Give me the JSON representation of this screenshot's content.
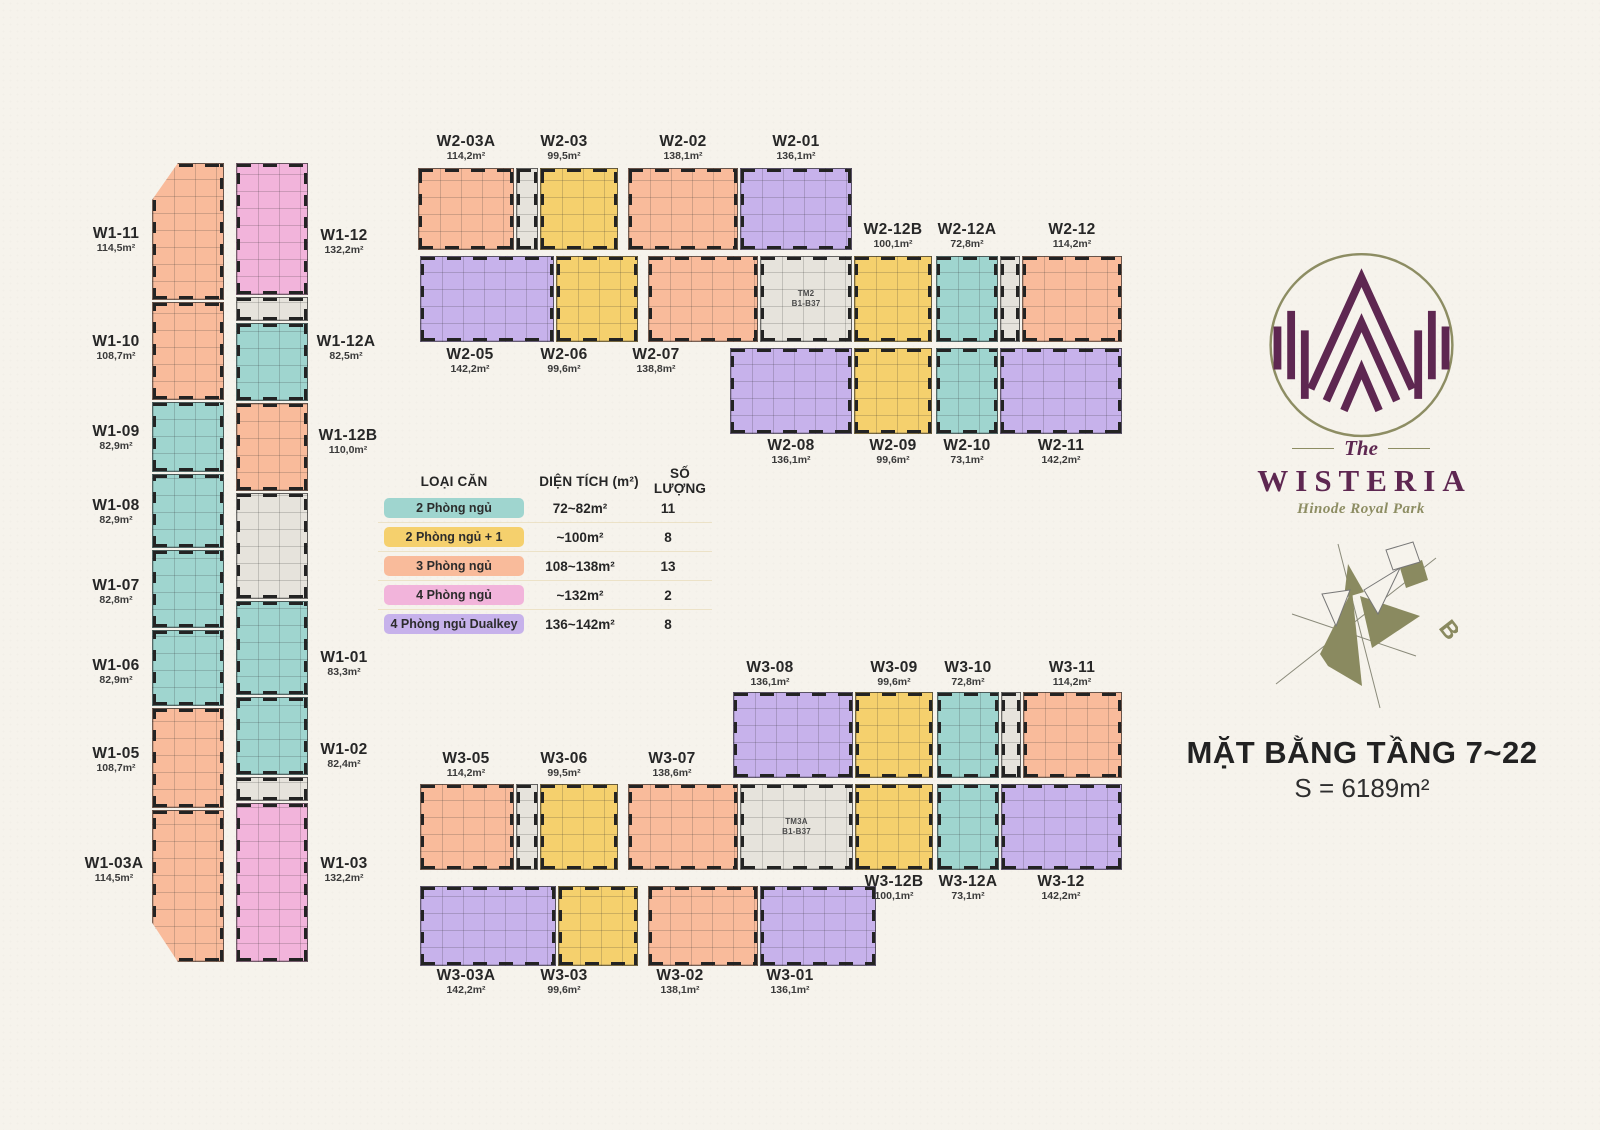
{
  "page": {
    "background": "#f6f3ec",
    "ink": "#2b2b2b"
  },
  "title": {
    "main": "MẶT BẰNG TẦNG 7~22",
    "area": "S = 6189m²"
  },
  "logo": {
    "the": "The",
    "name": "WISTERIA",
    "tagline": "Hinode Royal Park",
    "mark_color": "#5e2751",
    "ring_color": "#8d8d63"
  },
  "compass": {
    "label": "B",
    "color": "#8a8a60"
  },
  "legend": {
    "headers": [
      "LOẠI CĂN",
      "DIỆN TÍCH (m²)",
      "SỐ LƯỢNG"
    ],
    "rows": [
      {
        "label": "2 Phòng ngủ",
        "type": "2br",
        "color": "#9fd5cf",
        "area": "72~82m²",
        "count": "11"
      },
      {
        "label": "2 Phòng ngủ + 1",
        "type": "2br1",
        "color": "#f5d06d",
        "area": "~100m²",
        "count": "8"
      },
      {
        "label": "3 Phòng ngủ",
        "type": "3br",
        "color": "#f9bb9b",
        "area": "108~138m²",
        "count": "13"
      },
      {
        "label": "4 Phòng ngủ",
        "type": "4br",
        "color": "#f2b4db",
        "area": "~132m²",
        "count": "2"
      },
      {
        "label": "4 Phòng ngủ Dualkey",
        "type": "dual",
        "color": "#c7b2eb",
        "area": "136~142m²",
        "count": "8"
      }
    ]
  },
  "floorplan": {
    "colors": {
      "2br": "#9fd5cf",
      "2br1": "#f5d06d",
      "3br": "#f9bb9b",
      "4br": "#f2b4db",
      "dual": "#c7b2eb",
      "core": "#e6e3dc"
    },
    "units": [
      {
        "n": "W1-11",
        "t": "3br",
        "x": 152,
        "y": 163,
        "w": 72,
        "h": 137,
        "c": "tl"
      },
      {
        "n": "W1-10",
        "t": "3br",
        "x": 152,
        "y": 302,
        "w": 72,
        "h": 98
      },
      {
        "n": "W1-09",
        "t": "2br",
        "x": 152,
        "y": 402,
        "w": 72,
        "h": 70
      },
      {
        "n": "W1-08",
        "t": "2br",
        "x": 152,
        "y": 474,
        "w": 72,
        "h": 74
      },
      {
        "n": "W1-07",
        "t": "2br",
        "x": 152,
        "y": 550,
        "w": 72,
        "h": 78
      },
      {
        "n": "W1-06",
        "t": "2br",
        "x": 152,
        "y": 630,
        "w": 72,
        "h": 76
      },
      {
        "n": "W1-05",
        "t": "3br",
        "x": 152,
        "y": 708,
        "w": 72,
        "h": 100
      },
      {
        "n": "W1-03A",
        "t": "3br",
        "x": 152,
        "y": 810,
        "w": 72,
        "h": 152,
        "c": "bl"
      },
      {
        "n": "W1-12",
        "t": "4br",
        "x": 236,
        "y": 163,
        "w": 72,
        "h": 132
      },
      {
        "t": "core",
        "x": 236,
        "y": 297,
        "w": 72,
        "h": 24
      },
      {
        "n": "W1-12A",
        "t": "2br",
        "x": 236,
        "y": 323,
        "w": 72,
        "h": 78
      },
      {
        "n": "W1-12B",
        "t": "3br",
        "x": 236,
        "y": 403,
        "w": 72,
        "h": 88
      },
      {
        "t": "core",
        "x": 236,
        "y": 493,
        "w": 72,
        "h": 106
      },
      {
        "n": "W1-01",
        "t": "2br",
        "x": 236,
        "y": 601,
        "w": 72,
        "h": 94
      },
      {
        "n": "W1-02",
        "t": "2br",
        "x": 236,
        "y": 697,
        "w": 72,
        "h": 78
      },
      {
        "t": "core",
        "x": 236,
        "y": 777,
        "w": 72,
        "h": 24
      },
      {
        "n": "W1-03",
        "t": "4br",
        "x": 236,
        "y": 803,
        "w": 72,
        "h": 159
      },
      {
        "n": "W2-03A",
        "t": "3br",
        "x": 418,
        "y": 168,
        "w": 96,
        "h": 82
      },
      {
        "t": "core",
        "x": 516,
        "y": 168,
        "w": 22,
        "h": 82
      },
      {
        "n": "W2-03",
        "t": "2br1",
        "x": 540,
        "y": 168,
        "w": 78,
        "h": 82
      },
      {
        "n": "W2-02",
        "t": "3br",
        "x": 628,
        "y": 168,
        "w": 110,
        "h": 82
      },
      {
        "n": "W2-01",
        "t": "dual",
        "x": 740,
        "y": 168,
        "w": 112,
        "h": 82
      },
      {
        "n": "W2-05",
        "t": "dual",
        "x": 420,
        "y": 256,
        "w": 134,
        "h": 86
      },
      {
        "n": "W2-06",
        "t": "2br1",
        "x": 556,
        "y": 256,
        "w": 82,
        "h": 86
      },
      {
        "n": "W2-07",
        "t": "3br",
        "x": 648,
        "y": 256,
        "w": 110,
        "h": 86
      },
      {
        "t": "core",
        "x": 760,
        "y": 256,
        "w": 92,
        "h": 86,
        "lbl": "TM2\nB1-B37"
      },
      {
        "n": "W2-12B",
        "t": "2br1",
        "x": 854,
        "y": 256,
        "w": 78,
        "h": 86
      },
      {
        "n": "W2-12A",
        "t": "2br",
        "x": 936,
        "y": 256,
        "w": 62,
        "h": 86
      },
      {
        "t": "core",
        "x": 1000,
        "y": 256,
        "w": 20,
        "h": 86
      },
      {
        "n": "W2-12",
        "t": "3br",
        "x": 1022,
        "y": 256,
        "w": 100,
        "h": 86
      },
      {
        "n": "W2-08",
        "t": "dual",
        "x": 730,
        "y": 348,
        "w": 122,
        "h": 86
      },
      {
        "n": "W2-09",
        "t": "2br1",
        "x": 854,
        "y": 348,
        "w": 78,
        "h": 86
      },
      {
        "n": "W2-10",
        "t": "2br",
        "x": 936,
        "y": 348,
        "w": 62,
        "h": 86
      },
      {
        "n": "W2-11",
        "t": "dual",
        "x": 1000,
        "y": 348,
        "w": 122,
        "h": 86
      },
      {
        "n": "W3-08",
        "t": "dual",
        "x": 733,
        "y": 692,
        "w": 120,
        "h": 86
      },
      {
        "n": "W3-09",
        "t": "2br1",
        "x": 855,
        "y": 692,
        "w": 78,
        "h": 86
      },
      {
        "n": "W3-10",
        "t": "2br",
        "x": 937,
        "y": 692,
        "w": 62,
        "h": 86
      },
      {
        "t": "core",
        "x": 1001,
        "y": 692,
        "w": 20,
        "h": 86
      },
      {
        "n": "W3-11",
        "t": "3br",
        "x": 1023,
        "y": 692,
        "w": 99,
        "h": 86
      },
      {
        "n": "W3-05",
        "t": "3br",
        "x": 420,
        "y": 784,
        "w": 94,
        "h": 86
      },
      {
        "t": "core",
        "x": 516,
        "y": 784,
        "w": 22,
        "h": 86
      },
      {
        "n": "W3-06",
        "t": "2br1",
        "x": 540,
        "y": 784,
        "w": 78,
        "h": 86
      },
      {
        "n": "W3-07",
        "t": "3br",
        "x": 628,
        "y": 784,
        "w": 110,
        "h": 86
      },
      {
        "t": "core",
        "x": 740,
        "y": 784,
        "w": 113,
        "h": 86,
        "lbl": "TM3A\nB1-B37"
      },
      {
        "n": "W3-12B",
        "t": "2br1",
        "x": 855,
        "y": 784,
        "w": 78,
        "h": 86
      },
      {
        "n": "W3-12A",
        "t": "2br",
        "x": 937,
        "y": 784,
        "w": 62,
        "h": 86
      },
      {
        "n": "W3-12",
        "t": "dual",
        "x": 1001,
        "y": 784,
        "w": 121,
        "h": 86
      },
      {
        "n": "W3-03A",
        "t": "dual",
        "x": 420,
        "y": 886,
        "w": 136,
        "h": 80
      },
      {
        "n": "W3-03",
        "t": "2br1",
        "x": 558,
        "y": 886,
        "w": 80,
        "h": 80
      },
      {
        "n": "W3-02",
        "t": "3br",
        "x": 648,
        "y": 886,
        "w": 110,
        "h": 80
      },
      {
        "n": "W3-01",
        "t": "dual",
        "x": 760,
        "y": 886,
        "w": 116,
        "h": 80
      }
    ],
    "labels": [
      {
        "n": "W1-11",
        "a": "114,5m²",
        "x": 116,
        "y": 226
      },
      {
        "n": "W1-10",
        "a": "108,7m²",
        "x": 116,
        "y": 334
      },
      {
        "n": "W1-09",
        "a": "82,9m²",
        "x": 116,
        "y": 424
      },
      {
        "n": "W1-08",
        "a": "82,9m²",
        "x": 116,
        "y": 498
      },
      {
        "n": "W1-07",
        "a": "82,8m²",
        "x": 116,
        "y": 578
      },
      {
        "n": "W1-06",
        "a": "82,9m²",
        "x": 116,
        "y": 658
      },
      {
        "n": "W1-05",
        "a": "108,7m²",
        "x": 116,
        "y": 746
      },
      {
        "n": "W1-03A",
        "a": "114,5m²",
        "x": 114,
        "y": 856
      },
      {
        "n": "W1-12",
        "a": "132,2m²",
        "x": 344,
        "y": 228
      },
      {
        "n": "W1-12A",
        "a": "82,5m²",
        "x": 346,
        "y": 334
      },
      {
        "n": "W1-12B",
        "a": "110,0m²",
        "x": 348,
        "y": 428
      },
      {
        "n": "W1-01",
        "a": "83,3m²",
        "x": 344,
        "y": 650
      },
      {
        "n": "W1-02",
        "a": "82,4m²",
        "x": 344,
        "y": 742
      },
      {
        "n": "W1-03",
        "a": "132,2m²",
        "x": 344,
        "y": 856
      },
      {
        "n": "W2-03A",
        "a": "114,2m²",
        "x": 466,
        "y": 134
      },
      {
        "n": "W2-03",
        "a": "99,5m²",
        "x": 564,
        "y": 134
      },
      {
        "n": "W2-02",
        "a": "138,1m²",
        "x": 683,
        "y": 134
      },
      {
        "n": "W2-01",
        "a": "136,1m²",
        "x": 796,
        "y": 134
      },
      {
        "n": "W2-12B",
        "a": "100,1m²",
        "x": 893,
        "y": 222
      },
      {
        "n": "W2-12A",
        "a": "72,8m²",
        "x": 967,
        "y": 222
      },
      {
        "n": "W2-12",
        "a": "114,2m²",
        "x": 1072,
        "y": 222
      },
      {
        "n": "W2-05",
        "a": "142,2m²",
        "x": 470,
        "y": 347
      },
      {
        "n": "W2-06",
        "a": "99,6m²",
        "x": 564,
        "y": 347
      },
      {
        "n": "W2-07",
        "a": "138,8m²",
        "x": 656,
        "y": 347
      },
      {
        "n": "W2-08",
        "a": "136,1m²",
        "x": 791,
        "y": 438
      },
      {
        "n": "W2-09",
        "a": "99,6m²",
        "x": 893,
        "y": 438
      },
      {
        "n": "W2-10",
        "a": "73,1m²",
        "x": 967,
        "y": 438
      },
      {
        "n": "W2-11",
        "a": "142,2m²",
        "x": 1061,
        "y": 438
      },
      {
        "n": "W3-08",
        "a": "136,1m²",
        "x": 770,
        "y": 660
      },
      {
        "n": "W3-09",
        "a": "99,6m²",
        "x": 894,
        "y": 660
      },
      {
        "n": "W3-10",
        "a": "72,8m²",
        "x": 968,
        "y": 660
      },
      {
        "n": "W3-11",
        "a": "114,2m²",
        "x": 1072,
        "y": 660
      },
      {
        "n": "W3-05",
        "a": "114,2m²",
        "x": 466,
        "y": 751
      },
      {
        "n": "W3-06",
        "a": "99,5m²",
        "x": 564,
        "y": 751
      },
      {
        "n": "W3-07",
        "a": "138,6m²",
        "x": 672,
        "y": 751
      },
      {
        "n": "W3-12B",
        "a": "100,1m²",
        "x": 894,
        "y": 874
      },
      {
        "n": "W3-12A",
        "a": "73,1m²",
        "x": 968,
        "y": 874
      },
      {
        "n": "W3-12",
        "a": "142,2m²",
        "x": 1061,
        "y": 874
      },
      {
        "n": "W3-03A",
        "a": "142,2m²",
        "x": 466,
        "y": 968
      },
      {
        "n": "W3-03",
        "a": "99,6m²",
        "x": 564,
        "y": 968
      },
      {
        "n": "W3-02",
        "a": "138,1m²",
        "x": 680,
        "y": 968
      },
      {
        "n": "W3-01",
        "a": "136,1m²",
        "x": 790,
        "y": 968
      }
    ]
  }
}
